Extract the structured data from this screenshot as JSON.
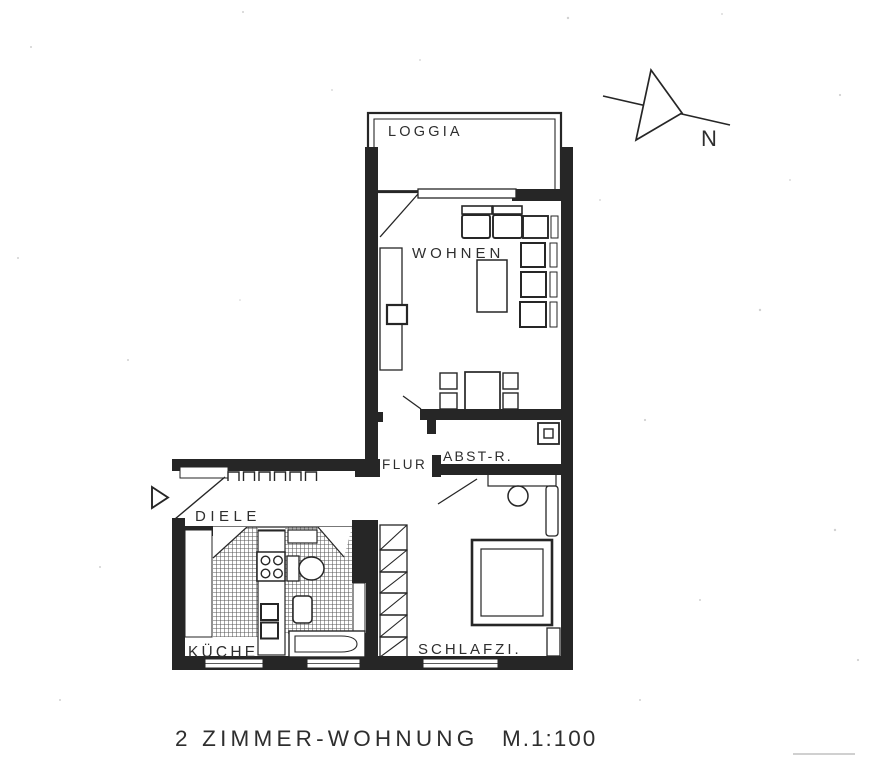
{
  "plan": {
    "rooms": {
      "loggia": "LOGGIA",
      "living": "WOHNEN",
      "hallway": "FLUR",
      "storage": "ABST-R.",
      "entry": "DIELE",
      "kitchen": "KÜCHE",
      "bedroom": "SCHLAFZI."
    },
    "caption": "2 ZIMMER-WOHNUNG",
    "scale_label": "M.1:100",
    "compass_label": "N"
  },
  "colors": {
    "ink": "#262626",
    "paper": "#ffffff"
  }
}
